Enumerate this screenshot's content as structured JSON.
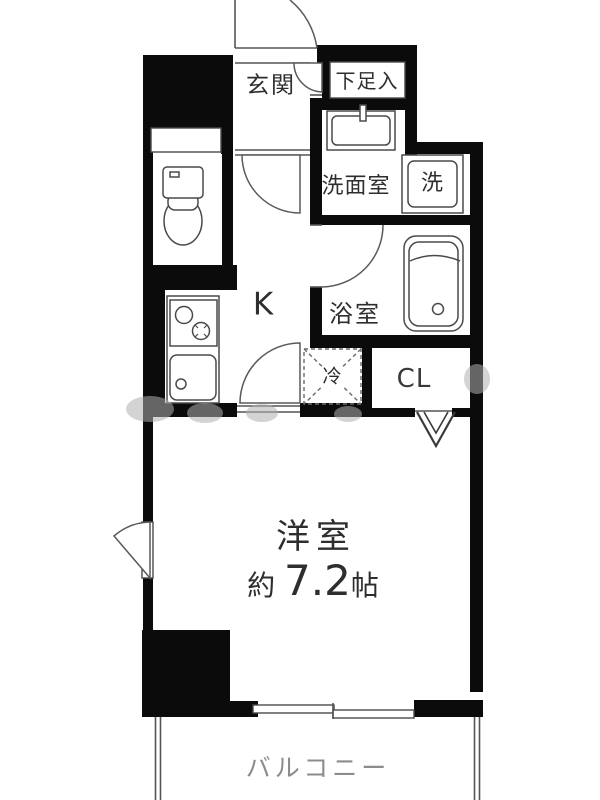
{
  "plan": {
    "type": "apartment-floor-plan",
    "rooms": {
      "genkan": {
        "label": "玄関"
      },
      "shoe_box": {
        "label": "下足入"
      },
      "washroom": {
        "label": "洗面室"
      },
      "washer": {
        "label": "洗"
      },
      "bathroom": {
        "label": "浴室"
      },
      "kitchen": {
        "label": "K"
      },
      "fridge": {
        "label": "冷"
      },
      "closet": {
        "label": "CL"
      },
      "main_room": {
        "label": "洋室",
        "size_prefix": "約",
        "size_value": "7.2",
        "size_unit": "帖"
      },
      "balcony": {
        "label": "バルコニー"
      }
    },
    "icons": {
      "toilet": "toilet-icon",
      "stove": "stove-icon",
      "kitchen_sink": "sink-icon",
      "washbasin": "washbasin-icon",
      "washer_pan": "washer-pan-icon",
      "bathtub": "bathtub-icon",
      "fridge_space": "fridge-space-icon",
      "closet_door": "folding-door-icon",
      "entrance_door": "door-swing-icon",
      "window": "casement-window-icon",
      "balcony_door": "sliding-door-icon"
    },
    "colors": {
      "wall": "#0b0b0b",
      "line": "#555555",
      "text": "#2e2e2e",
      "balcony_text": "#8c8c8c",
      "watermark": "#b0b0b0",
      "background": "#ffffff"
    }
  }
}
